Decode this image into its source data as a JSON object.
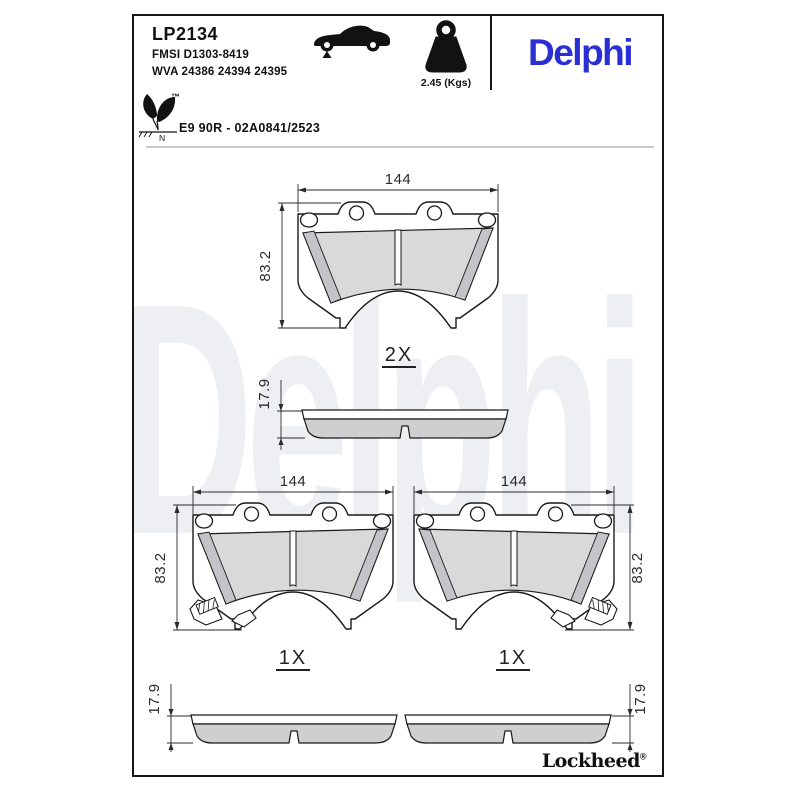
{
  "colors": {
    "brand_blue": "#2a2fd4",
    "watermark_gray": "#edeff2",
    "friction_gray": "#d9d9d9",
    "chamfer_gray": "#c4c4c8",
    "profile_friction_gray": "#cfcfcf",
    "line_black": "#1a1a1a"
  },
  "header": {
    "part_number": "LP2134",
    "fmsi": "FMSI D1303-8419",
    "wva": "WVA 24386 24394 24395",
    "weight": "2.45 (Kgs)",
    "brand_logo": "Delphi",
    "approval": "E9 90R - 02A0841/2523",
    "eco_mark_letter": "N",
    "trademark": "™"
  },
  "watermark_text": "Delphi",
  "drawings": {
    "pad_top": {
      "width": "144",
      "height": "83.2",
      "quantity": "2X"
    },
    "profile_top": {
      "thickness": "17.9"
    },
    "pad_bottom_left": {
      "width": "144",
      "height": "83.2",
      "quantity": "1X"
    },
    "pad_bottom_right": {
      "width": "144",
      "height": "83.2",
      "quantity": "1X"
    },
    "profile_bottom_left": {
      "thickness": "17.9"
    },
    "profile_bottom_right": {
      "thickness": "17.9"
    }
  },
  "footer": {
    "brand": "Lockheed",
    "registered": "®"
  }
}
